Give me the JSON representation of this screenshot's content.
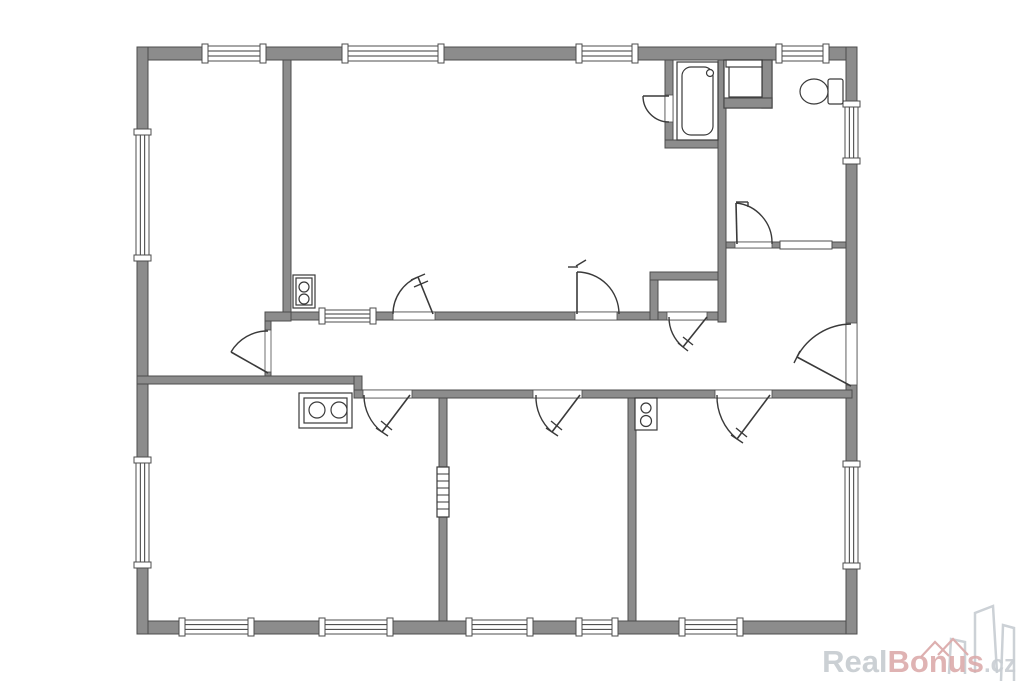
{
  "watermark": {
    "real": "Real",
    "bonus": "Bonus",
    "cz": ".cz",
    "colors": {
      "real": "#c6cbd0",
      "bonus": "#dcabab",
      "cz": "#c9ced3",
      "buildings": "#ccd1d6",
      "roofs": "#ddafaf"
    }
  },
  "floorplan": {
    "canvas": {
      "width": 1024,
      "height": 683
    },
    "colors": {
      "bg": "#ffffff",
      "wall_fill": "#8c8c8c",
      "wall_stroke": "#4c4c4c",
      "line": "#3a3a3a"
    },
    "walls": [
      {
        "name": "outer-wall-top",
        "x": 137,
        "y": 47,
        "w": 720,
        "h": 13
      },
      {
        "name": "outer-wall-bottom",
        "x": 137,
        "y": 621,
        "w": 720,
        "h": 13
      },
      {
        "name": "outer-wall-left",
        "x": 137,
        "y": 47,
        "w": 11,
        "h": 587
      },
      {
        "name": "outer-wall-right",
        "x": 846,
        "y": 47,
        "w": 11,
        "h": 587
      },
      {
        "name": "wall-divider-room1-room2",
        "x": 283,
        "y": 60,
        "w": 8,
        "h": 253
      },
      {
        "name": "wall-jog-room1",
        "x": 265,
        "y": 312,
        "w": 26,
        "h": 9
      },
      {
        "name": "wall-stub-above-door1",
        "x": 265,
        "y": 321,
        "w": 6,
        "h": 9
      },
      {
        "name": "wall-stub-below-door1",
        "x": 265,
        "y": 372,
        "w": 6,
        "h": 6
      },
      {
        "name": "wall-corridor-top",
        "x": 291,
        "y": 312,
        "w": 367,
        "h": 8
      },
      {
        "name": "wall-closet-bottom",
        "x": 658,
        "y": 312,
        "w": 60,
        "h": 8
      },
      {
        "name": "wall-closet-top",
        "x": 650,
        "y": 272,
        "w": 68,
        "h": 8
      },
      {
        "name": "wall-closet-left",
        "x": 650,
        "y": 280,
        "w": 8,
        "h": 40
      },
      {
        "name": "wall-bathroom-left",
        "x": 665,
        "y": 60,
        "w": 8,
        "h": 88
      },
      {
        "name": "wall-bathroom-bottom",
        "x": 665,
        "y": 140,
        "w": 61,
        "h": 8
      },
      {
        "name": "wall-vertical-long",
        "x": 718,
        "y": 60,
        "w": 8,
        "h": 262
      },
      {
        "name": "wall-wc-room-bottom",
        "x": 726,
        "y": 242,
        "w": 120,
        "h": 6
      },
      {
        "name": "wall-corridor-bottom-left",
        "x": 137,
        "y": 376,
        "w": 225,
        "h": 8
      },
      {
        "name": "wall-corridor-jog",
        "x": 354,
        "y": 376,
        "w": 8,
        "h": 22
      },
      {
        "name": "wall-corridor-bottom-right",
        "x": 354,
        "y": 390,
        "w": 498,
        "h": 8
      },
      {
        "name": "wall-divider-kitchen-room4",
        "x": 439,
        "y": 398,
        "w": 8,
        "h": 223
      },
      {
        "name": "wall-divider-room4-room5",
        "x": 628,
        "y": 398,
        "w": 8,
        "h": 223
      }
    ],
    "windows": [
      {
        "name": "window-top-room1",
        "x": 203,
        "y": 46,
        "w": 62,
        "h": 15,
        "orient": "h"
      },
      {
        "name": "window-top-room2-a",
        "x": 343,
        "y": 46,
        "w": 100,
        "h": 15,
        "orient": "h"
      },
      {
        "name": "window-top-room2-b",
        "x": 577,
        "y": 46,
        "w": 60,
        "h": 15,
        "orient": "h"
      },
      {
        "name": "window-top-wc-room",
        "x": 777,
        "y": 46,
        "w": 51,
        "h": 15,
        "orient": "h"
      },
      {
        "name": "window-left-room1",
        "x": 136,
        "y": 130,
        "w": 13,
        "h": 130,
        "orient": "v"
      },
      {
        "name": "window-left-kitchen",
        "x": 136,
        "y": 458,
        "w": 13,
        "h": 109,
        "orient": "v"
      },
      {
        "name": "window-right-wc-room",
        "x": 845,
        "y": 102,
        "w": 13,
        "h": 61,
        "orient": "v"
      },
      {
        "name": "window-right-room5",
        "x": 845,
        "y": 462,
        "w": 13,
        "h": 106,
        "orient": "v"
      },
      {
        "name": "window-bottom-kitchen-a",
        "x": 180,
        "y": 620,
        "w": 73,
        "h": 14,
        "orient": "h"
      },
      {
        "name": "window-bottom-kitchen-b",
        "x": 320,
        "y": 620,
        "w": 72,
        "h": 14,
        "orient": "h"
      },
      {
        "name": "window-bottom-room4-a",
        "x": 467,
        "y": 620,
        "w": 65,
        "h": 14,
        "orient": "h"
      },
      {
        "name": "window-bottom-room4-b",
        "x": 577,
        "y": 620,
        "w": 40,
        "h": 14,
        "orient": "h"
      },
      {
        "name": "window-bottom-room5",
        "x": 680,
        "y": 620,
        "w": 62,
        "h": 14,
        "orient": "h"
      },
      {
        "name": "interior-window-corridor",
        "x": 320,
        "y": 310,
        "w": 55,
        "h": 12,
        "orient": "h"
      },
      {
        "name": "interior-window-hall-wc",
        "x": 780,
        "y": 241,
        "w": 52,
        "h": 8,
        "orient": "h",
        "plain": true
      }
    ],
    "openings": [
      {
        "name": "door-opening-room1",
        "x": 265,
        "y": 330,
        "w": 6,
        "h": 42
      },
      {
        "name": "door-opening-room2-a",
        "x": 393,
        "y": 312,
        "w": 42,
        "h": 8
      },
      {
        "name": "door-opening-room2-b",
        "x": 575,
        "y": 312,
        "w": 42,
        "h": 8
      },
      {
        "name": "door-opening-bathroom",
        "x": 665,
        "y": 95,
        "w": 8,
        "h": 27
      },
      {
        "name": "door-opening-wc-room",
        "x": 735,
        "y": 242,
        "w": 37,
        "h": 6
      },
      {
        "name": "door-opening-closet",
        "x": 667,
        "y": 312,
        "w": 40,
        "h": 8
      },
      {
        "name": "door-opening-kitchen",
        "x": 363,
        "y": 390,
        "w": 49,
        "h": 8
      },
      {
        "name": "door-opening-room4",
        "x": 533,
        "y": 390,
        "w": 49,
        "h": 8
      },
      {
        "name": "door-opening-room5",
        "x": 715,
        "y": 390,
        "w": 57,
        "h": 8
      },
      {
        "name": "entrance-opening",
        "x": 846,
        "y": 323,
        "w": 11,
        "h": 62
      }
    ],
    "doors": [
      {
        "name": "door-room1",
        "arc": "M 268,331 A 42 42 0 0 0 231,352",
        "leaf": [
          268,
          373,
          231,
          352
        ],
        "ticks": []
      },
      {
        "name": "door-room2-a",
        "arc": "M 393,314 A 40 40 0 0 1 418,277",
        "leaf": [
          433,
          314,
          418,
          277
        ],
        "ticks": [
          [
            425,
            274,
            411,
            280
          ],
          [
            428,
            281,
            414,
            287
          ]
        ]
      },
      {
        "name": "door-room2-b",
        "arc": "M 619,314 A 42 42 0 0 0 577,272",
        "leaf": [
          577,
          314,
          577,
          272
        ],
        "ticks": [
          [
            568,
            267,
            578,
            267
          ],
          [
            576,
            266,
            586,
            260
          ]
        ]
      },
      {
        "name": "door-bathroom",
        "arc": "M 643,96 A 26 26 0 0 0 669,122",
        "leaf": [
          669,
          96,
          643,
          96
        ],
        "ticks": []
      },
      {
        "name": "door-wc-room",
        "arc": "M 736,203 A 40 40 0 0 1 772,244",
        "leaf": [
          737,
          244,
          736,
          203
        ],
        "ticks": [
          [
            736,
            202,
            748,
            202
          ],
          [
            748,
            202,
            748,
            207
          ]
        ]
      },
      {
        "name": "door-closet",
        "arc": "M 669,317 A 38 38 0 0 0 683,347",
        "leaf": [
          707,
          317,
          683,
          347
        ],
        "ticks": [
          [
            678,
            343,
            688,
            351
          ],
          [
            683,
            337,
            693,
            345
          ]
        ]
      },
      {
        "name": "door-kitchen",
        "arc": "M 364,395 A 46 46 0 0 0 382,432",
        "leaf": [
          410,
          395,
          382,
          432
        ],
        "ticks": [
          [
            376,
            428,
            388,
            436
          ],
          [
            381,
            421,
            392,
            430
          ]
        ]
      },
      {
        "name": "door-room4",
        "arc": "M 536,395 A 46 46 0 0 0 552,432",
        "leaf": [
          580,
          395,
          552,
          432
        ],
        "ticks": [
          [
            546,
            428,
            558,
            436
          ],
          [
            551,
            421,
            562,
            430
          ]
        ]
      },
      {
        "name": "door-room5",
        "arc": "M 717,395 A 55 55 0 0 0 737,439",
        "leaf": [
          770,
          395,
          737,
          439
        ],
        "ticks": [
          [
            731,
            435,
            743,
            443
          ],
          [
            736,
            428,
            747,
            437
          ]
        ]
      },
      {
        "name": "entrance-door",
        "arc": "M 851,324 A 62 62 0 0 0 797,357",
        "leaf": [
          851,
          386,
          797,
          357
        ],
        "ticks": [
          [
            800,
            351,
            794,
            363
          ]
        ]
      }
    ],
    "fixtures": [
      {
        "name": "bathtub",
        "rects": [
          [
            677,
            62,
            41,
            78,
            0
          ],
          [
            682,
            67,
            31,
            68,
            9
          ]
        ],
        "circles": [
          [
            710,
            73,
            3.5
          ]
        ],
        "lines": []
      },
      {
        "name": "shower",
        "rects": [
          [
            724,
            60,
            48,
            48,
            0
          ],
          [
            762,
            60,
            10,
            48,
            0,
            "wall"
          ],
          [
            724,
            98,
            48,
            10,
            0,
            "wall"
          ],
          [
            729,
            66,
            33,
            31,
            0
          ],
          [
            726,
            60,
            36,
            7,
            0
          ]
        ],
        "circles": [],
        "lines": []
      },
      {
        "name": "toilet",
        "rects": [
          [
            828,
            79,
            15,
            25,
            2
          ]
        ],
        "circles": [],
        "ellipses": [
          [
            814,
            91.5,
            14,
            12.5
          ]
        ],
        "lines": [
          [
            828,
            80,
            828,
            103
          ]
        ]
      },
      {
        "name": "water-heater",
        "rects": [
          [
            293,
            275,
            22,
            33,
            0
          ],
          [
            296,
            278,
            16,
            27,
            0
          ]
        ],
        "circles": [
          [
            304,
            287,
            5
          ],
          [
            304,
            299,
            5
          ]
        ],
        "lines": []
      },
      {
        "name": "stove",
        "rects": [
          [
            299,
            393,
            53,
            35,
            0
          ],
          [
            304,
            398,
            43,
            25,
            0
          ]
        ],
        "circles": [
          [
            317,
            410,
            8
          ],
          [
            339,
            410,
            8
          ]
        ],
        "lines": []
      },
      {
        "name": "appliance",
        "rects": [
          [
            635,
            398,
            22,
            32,
            0
          ]
        ],
        "circles": [
          [
            646,
            408,
            5
          ],
          [
            646,
            421,
            5.5
          ]
        ],
        "lines": []
      },
      {
        "name": "vent-shaft",
        "rects": [
          [
            437,
            467,
            12,
            50,
            0
          ]
        ],
        "circles": [],
        "lines": [
          [
            437,
            474,
            449,
            474
          ],
          [
            437,
            481,
            449,
            481
          ],
          [
            437,
            488,
            449,
            488
          ],
          [
            437,
            495,
            449,
            495
          ],
          [
            437,
            502,
            449,
            502
          ],
          [
            437,
            509,
            449,
            509
          ]
        ]
      }
    ],
    "watermark_art": {
      "buildings": [
        "949,674 951,639 965,642 965,674",
        "975,673 975,613 993,606 997,673",
        "1001,681 1003,625 1014,628 1014,681"
      ],
      "roofs": "M921,657 L935,642 L949,656 M938,655 L953,639 L968,655"
    }
  }
}
